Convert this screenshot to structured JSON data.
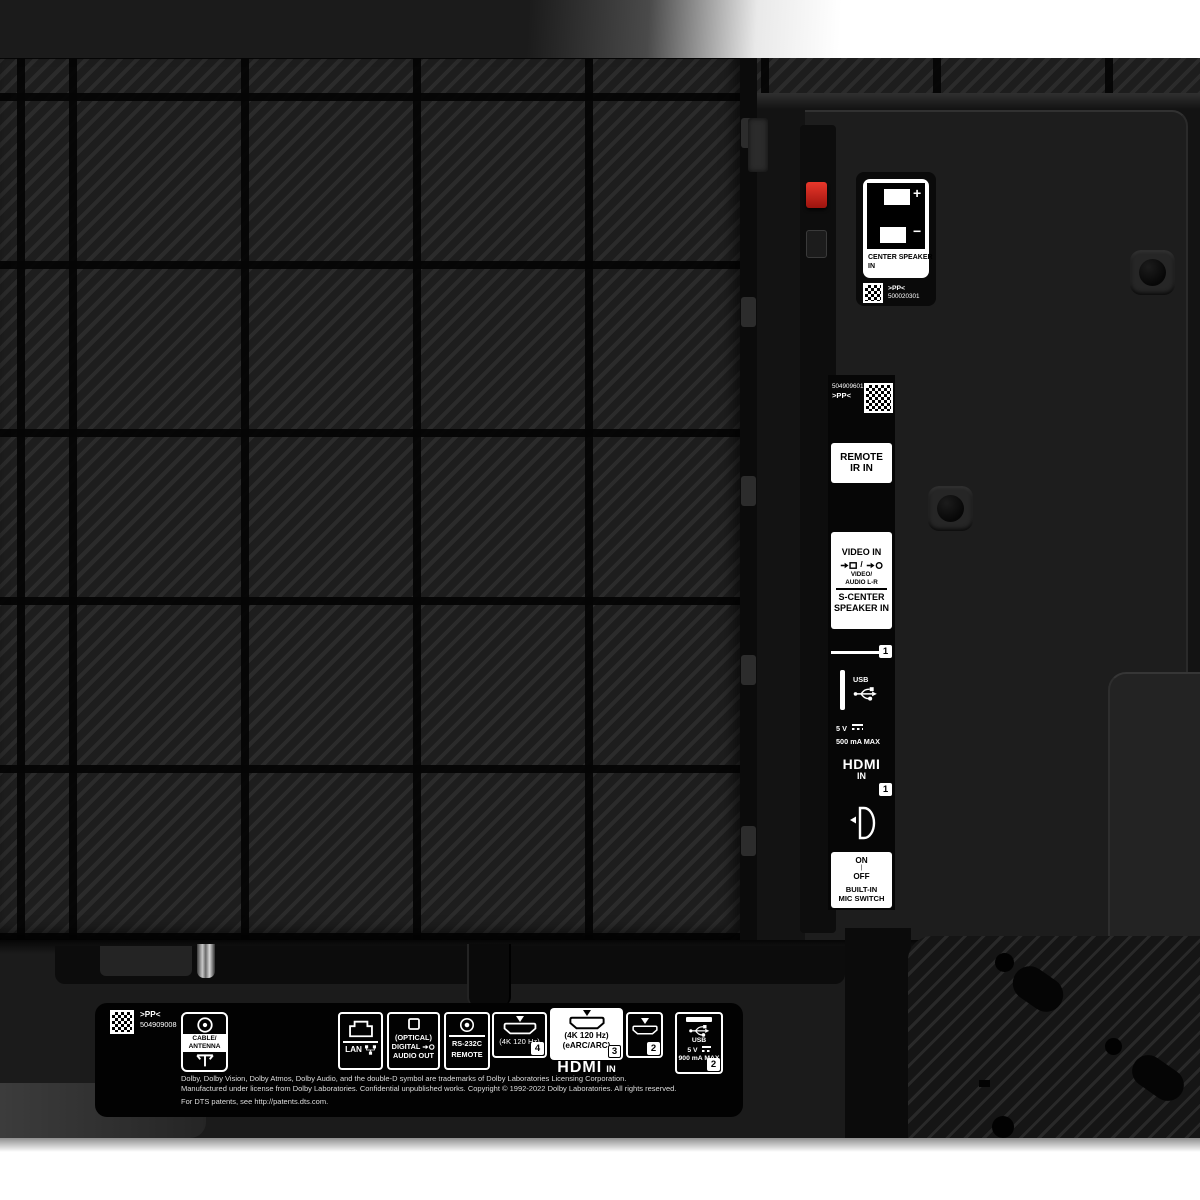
{
  "photo": {
    "subject": "tv-rear-panel"
  },
  "center_speaker": {
    "plus": "+",
    "minus": "−",
    "title_line1": "CENTER SPEAKER",
    "title_line2": "IN",
    "code_mark": ">PP<",
    "code_number": "500020301"
  },
  "side_strip": {
    "serial": "504909601",
    "serial_mark": ">PP<",
    "remote_ir_line1": "REMOTE",
    "remote_ir_line2": "IR IN",
    "video_in_title": "VIDEO IN",
    "icon_divider": "/",
    "video_sub1": "VIDEO/",
    "video_sub2": "AUDIO L-R",
    "s_center_line1": "S-CENTER",
    "s_center_line2": "SPEAKER IN",
    "usb_port_number": "1",
    "usb_label": "USB",
    "usb_voltage": "5 V",
    "usb_current": "500 mA MAX",
    "hdmi_label": "HDMI",
    "hdmi_in": "IN",
    "hdmi_port_number": "1",
    "mic_on": "ON",
    "mic_sep": "|",
    "mic_off": "OFF",
    "mic_line1": "BUILT-IN",
    "mic_line2": "MIC SWITCH"
  },
  "bottom_strip": {
    "code_mark": ">PP<",
    "code_number": "504909008",
    "cable_line1": "CABLE/",
    "cable_line2": "ANTENNA",
    "lan_label": "LAN",
    "optical_title": "(OPTICAL)",
    "optical_line1": "DIGITAL",
    "optical_line2": "AUDIO OUT",
    "rs232c_title": "RS-232C",
    "rs232c_sub": "REMOTE",
    "hdmi4_spec": "(4K 120 Hz)",
    "hdmi4_number": "4",
    "hdmi3_spec1": "(4K 120 Hz)",
    "hdmi3_spec2": "(eARC/ARC)",
    "hdmi3_number": "3",
    "hdmi2_number": "2",
    "hdmi_in_label": "HDMI",
    "hdmi_in_suffix": "IN",
    "usb_label": "USB",
    "usb_voltage": "5 V",
    "usb_current": "900 mA MAX",
    "usb_number": "2",
    "legal_line1": "Dolby, Dolby Vision, Dolby Atmos, Dolby Audio, and the double-D symbol are trademarks of Dolby Laboratories Licensing Corporation.",
    "legal_line2": "Manufactured under license from Dolby Laboratories. Confidential unpublished works. Copyright © 1992-2022 Dolby Laboratories. All rights reserved.",
    "legal_line3": "For DTS patents, see http://patents.dts.com."
  },
  "colors": {
    "accent_red": "#c42318",
    "panel_dark": "#1d1d1d",
    "label_black": "#050505",
    "label_white": "#ffffff"
  }
}
